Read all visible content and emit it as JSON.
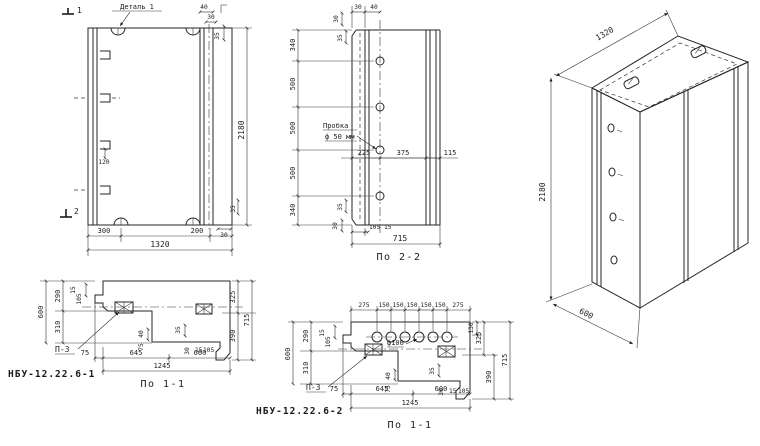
{
  "views": {
    "front": {
      "detail_label": "Деталь 1",
      "marker_top": "1",
      "marker_bottom": "2",
      "dims": {
        "top_a": "40",
        "top_b": "30",
        "top_c": "35",
        "height": "2180",
        "hook": "120",
        "side_a": "35",
        "side_b": "30",
        "bottom_left": "300",
        "bottom_right": "200",
        "width": "1320"
      }
    },
    "section22": {
      "title": "По 2-2",
      "plug_line1": "Пробка",
      "plug_line2": "ф 50 мм",
      "dims": {
        "top_a": "30",
        "top_b": "40",
        "tl_a": "30",
        "tl_b": "35",
        "left_chain": [
          "340",
          "500",
          "500",
          "500",
          "340"
        ],
        "bl_a": "35",
        "bl_b": "30",
        "mid": [
          "225",
          "375",
          "115"
        ],
        "bottom_a": "105",
        "bottom_b": "15",
        "width": "715"
      }
    },
    "iso": {
      "dims": {
        "width": "1320",
        "height": "2180",
        "depth": "600"
      }
    },
    "s11a": {
      "code": "НБУ-12.22.6-1",
      "title": "По 1-1",
      "embed_label": "П-3",
      "dims": {
        "left_total": "600",
        "left_a": "290",
        "left_b": "310",
        "left_small_a": "15",
        "left_small_b": "105",
        "right_a": "325",
        "right_b": "390",
        "right_total": "715",
        "bottom_a": "75",
        "bottom_b": "645",
        "bottom_c": "600",
        "bottom_total": "1245",
        "small_a": "40",
        "small_b": "75",
        "small_c": "35",
        "small_d": "30",
        "small_e": "15",
        "small_f": "105"
      }
    },
    "s11b": {
      "code": "НБУ-12.22.6-2",
      "title": "По 1-1",
      "embed_label": "П-3",
      "hole_label": "ф100",
      "dims": {
        "top": [
          "275",
          "150",
          "150",
          "150",
          "150",
          "150",
          "275"
        ],
        "left_total": "600",
        "left_a": "290",
        "left_b": "310",
        "left_small_a": "15",
        "left_small_b": "105",
        "right_a": "130",
        "right_b": "325",
        "right_c": "390",
        "right_total": "715",
        "bottom_a": "75",
        "bottom_b": "645",
        "bottom_c": "600",
        "bottom_total": "1245",
        "small_a": "40",
        "small_b": "75",
        "small_c": "35",
        "small_d": "30",
        "small_e": "15",
        "small_f": "105"
      }
    }
  }
}
